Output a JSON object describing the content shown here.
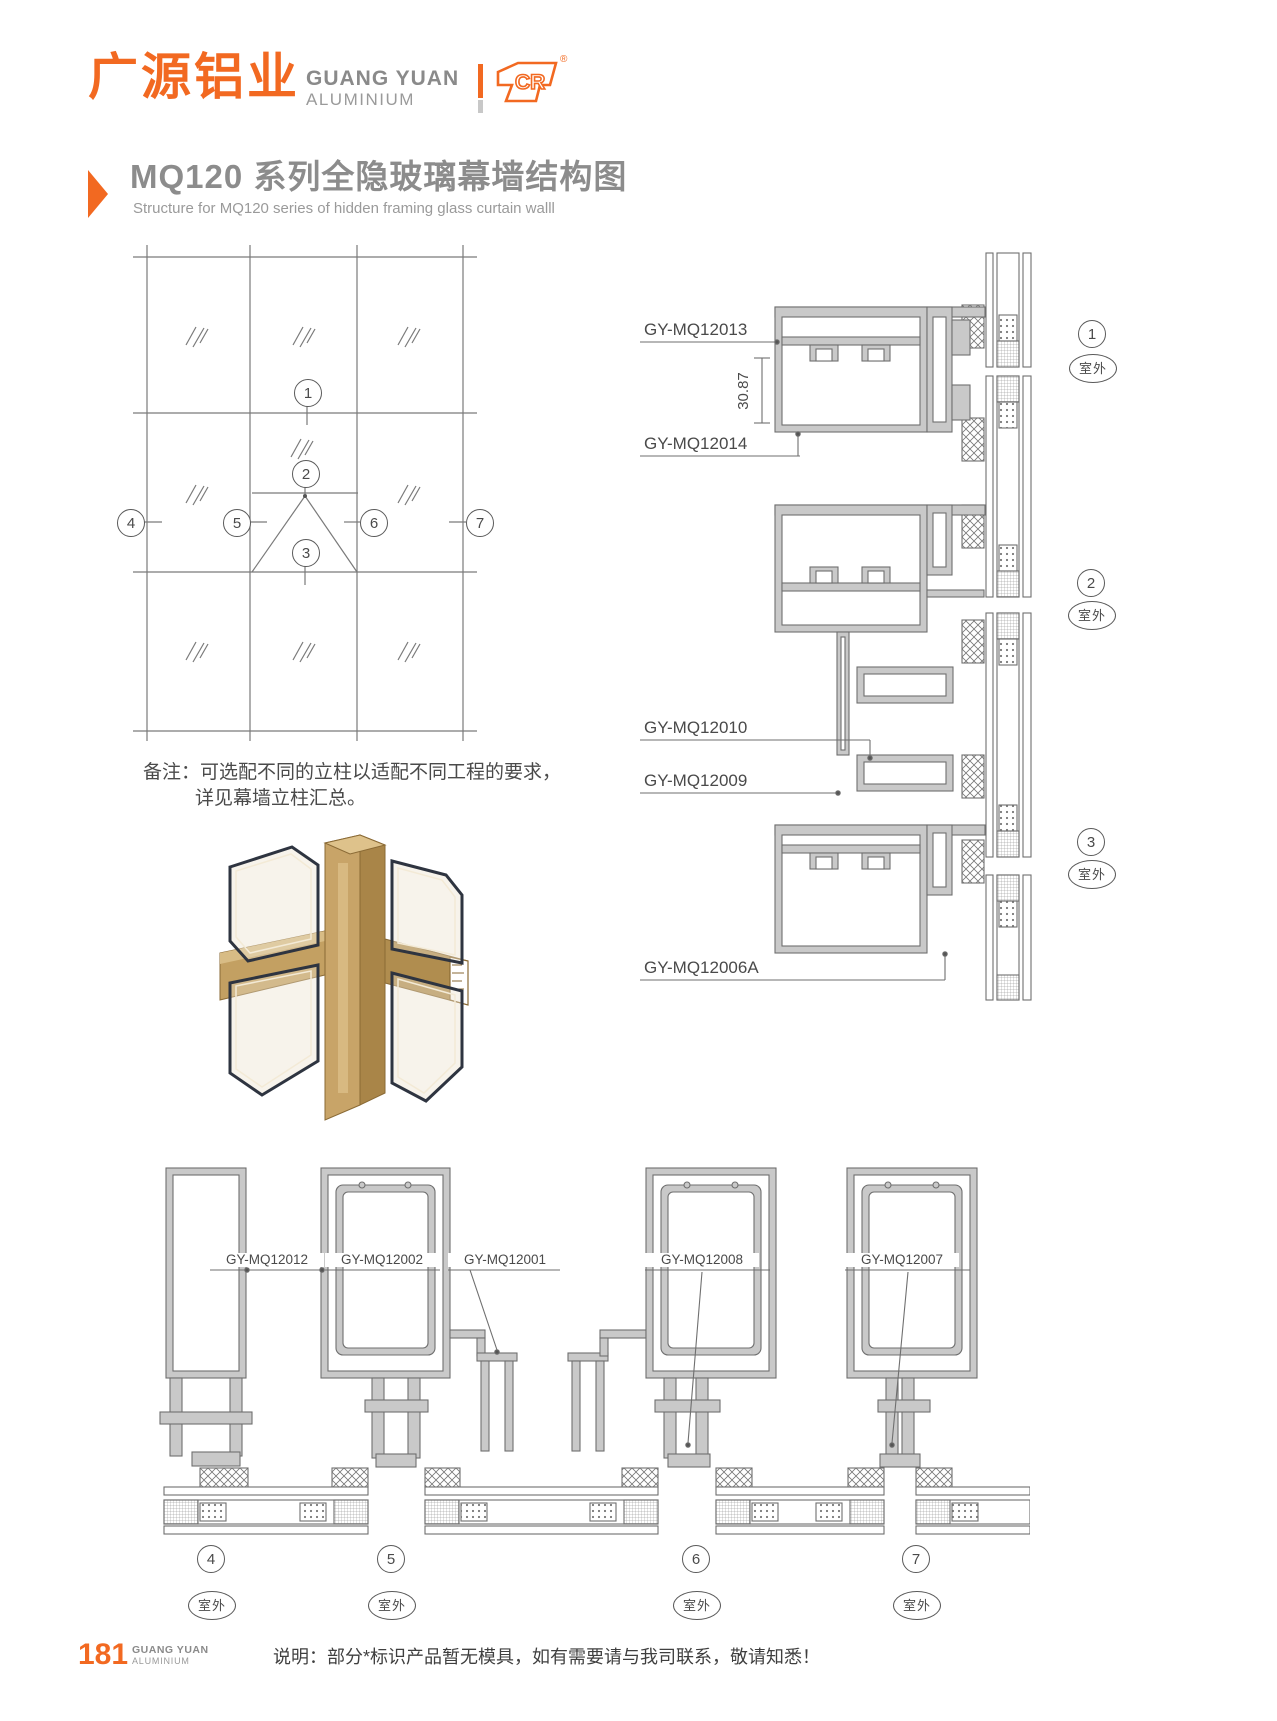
{
  "header": {
    "logo_cn": "广源铝业",
    "logo_en1": "GUANG YUAN",
    "logo_en2": "ALUMINIUM",
    "cr": "CR",
    "reg": "®"
  },
  "title": {
    "cn": "MQ120 系列全隐玻璃幕墙结构图",
    "en": "Structure for MQ120 series of hidden framing glass curtain walll"
  },
  "elevation": {
    "callouts": [
      "1",
      "2",
      "3",
      "4",
      "5",
      "6",
      "7"
    ]
  },
  "details": {
    "labels": [
      "GY-MQ12013",
      "GY-MQ12014",
      "GY-MQ12010",
      "GY-MQ12009",
      "GY-MQ12006A"
    ],
    "dim": "30.87",
    "callouts": [
      {
        "num": "1",
        "outdoor": "室外"
      },
      {
        "num": "2",
        "outdoor": "室外"
      },
      {
        "num": "3",
        "outdoor": "室外"
      }
    ]
  },
  "note": {
    "line1": "备注：可选配不同的立柱以适配不同工程的要求，",
    "line2": "详见幕墙立柱汇总。"
  },
  "bottom": {
    "labels": [
      "GY-MQ12012",
      "GY-MQ12002",
      "GY-MQ12001",
      "GY-MQ12008",
      "GY-MQ12007"
    ],
    "callouts": [
      {
        "num": "4",
        "outdoor": "室外"
      },
      {
        "num": "5",
        "outdoor": "室外"
      },
      {
        "num": "6",
        "outdoor": "室外"
      },
      {
        "num": "7",
        "outdoor": "室外"
      }
    ]
  },
  "footer": {
    "page": "181",
    "brand1": "GUANG YUAN",
    "brand2": "ALUMINIUM",
    "note": "说明：部分*标识产品暂无模具，如有需要请与我司联系，敬请知悉！"
  },
  "colors": {
    "accent": "#F26921",
    "title_gray": "#8C8C8C",
    "drawing_stroke": "#6F6F6F",
    "aluminium_fill": "#C9C9C9",
    "bronze": "#C8A468"
  }
}
